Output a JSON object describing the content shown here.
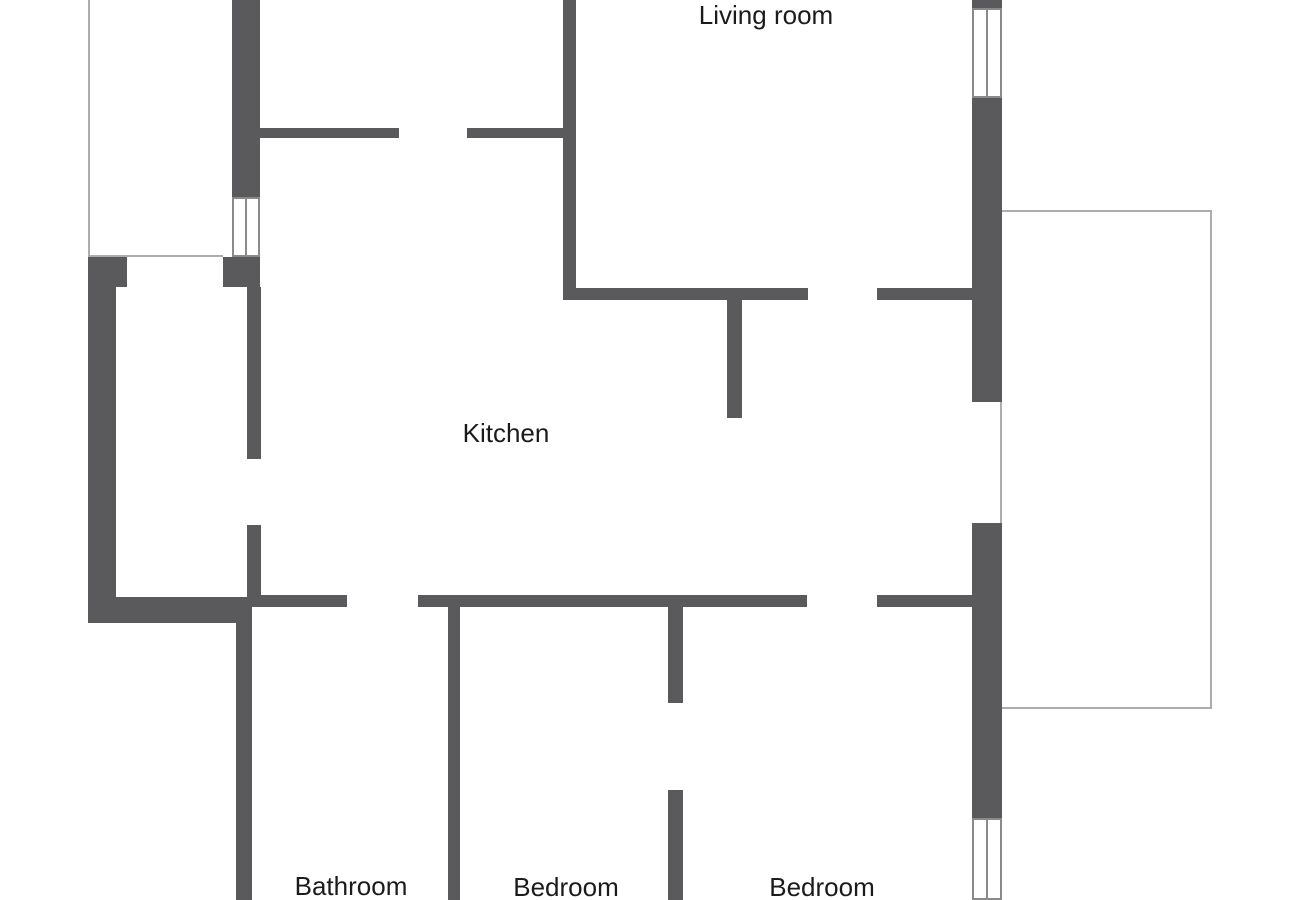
{
  "colors": {
    "background": "#ffffff",
    "wall": "#5a5a5c",
    "thin_line": "#adadad",
    "window_border": "#8a8a8a",
    "label_text": "#1b1b1b"
  },
  "rooms": [
    {
      "name": "room-label-living-room",
      "label": "Living room",
      "cx": 766,
      "cy": 15
    },
    {
      "name": "room-label-kitchen",
      "label": "Kitchen",
      "cx": 506,
      "cy": 433
    },
    {
      "name": "room-label-bathroom",
      "label": "Bathroom",
      "cx": 351,
      "cy": 886
    },
    {
      "name": "room-label-bedroom-1",
      "label": "Bedroom",
      "cx": 566,
      "cy": 887
    },
    {
      "name": "room-label-bedroom-2",
      "label": "Bedroom",
      "cx": 822,
      "cy": 887
    }
  ],
  "walls": [
    {
      "name": "wall-top-left-vertical",
      "x": 232,
      "y": 0,
      "w": 28,
      "h": 197
    },
    {
      "name": "wall-hall-top-a",
      "x": 255,
      "y": 128,
      "w": 144,
      "h": 10
    },
    {
      "name": "wall-hall-top-b",
      "x": 467,
      "y": 128,
      "w": 109,
      "h": 10
    },
    {
      "name": "wall-center-vertical",
      "x": 563,
      "y": 0,
      "w": 13,
      "h": 300
    },
    {
      "name": "wall-living-kitchen-a",
      "x": 563,
      "y": 288,
      "w": 245,
      "h": 12
    },
    {
      "name": "wall-living-kitchen-stub",
      "x": 727,
      "y": 300,
      "w": 15,
      "h": 118
    },
    {
      "name": "wall-living-kitchen-b",
      "x": 877,
      "y": 288,
      "w": 125,
      "h": 12
    },
    {
      "name": "wall-right-top-stub",
      "x": 972,
      "y": 0,
      "w": 30,
      "h": 8
    },
    {
      "name": "wall-right-upper",
      "x": 972,
      "y": 98,
      "w": 30,
      "h": 304
    },
    {
      "name": "wall-right-mid",
      "x": 972,
      "y": 523,
      "w": 30,
      "h": 295
    },
    {
      "name": "wall-left-corner-block",
      "x": 88,
      "y": 257,
      "w": 39,
      "h": 30
    },
    {
      "name": "wall-left-outer",
      "x": 88,
      "y": 287,
      "w": 28,
      "h": 336
    },
    {
      "name": "wall-entry-block",
      "x": 223,
      "y": 257,
      "w": 37,
      "h": 30
    },
    {
      "name": "wall-hall-vertical-upper",
      "x": 247,
      "y": 287,
      "w": 14,
      "h": 172
    },
    {
      "name": "wall-hall-vertical-lower",
      "x": 247,
      "y": 525,
      "w": 14,
      "h": 82
    },
    {
      "name": "wall-left-step",
      "x": 116,
      "y": 597,
      "w": 134,
      "h": 26
    },
    {
      "name": "wall-bathroom-left",
      "x": 236,
      "y": 597,
      "w": 16,
      "h": 303
    },
    {
      "name": "wall-hall-bottom",
      "x": 252,
      "y": 595,
      "w": 95,
      "h": 12
    },
    {
      "name": "wall-kitchen-bottom",
      "x": 418,
      "y": 595,
      "w": 389,
      "h": 12
    },
    {
      "name": "wall-bath-bedroom-divider",
      "x": 448,
      "y": 605,
      "w": 12,
      "h": 295
    },
    {
      "name": "wall-bedroom-divider-upper",
      "x": 668,
      "y": 605,
      "w": 15,
      "h": 98
    },
    {
      "name": "wall-bedroom-divider-lower",
      "x": 668,
      "y": 790,
      "w": 15,
      "h": 110
    },
    {
      "name": "wall-kitchen-bottom-b",
      "x": 877,
      "y": 595,
      "w": 125,
      "h": 12
    }
  ],
  "windows": [
    {
      "name": "window-top-left",
      "x": 232,
      "y": 197,
      "w": 28,
      "h": 60
    },
    {
      "name": "window-right-top",
      "x": 972,
      "y": 8,
      "w": 30,
      "h": 90
    },
    {
      "name": "window-right-bottom",
      "x": 972,
      "y": 818,
      "w": 30,
      "h": 82
    }
  ],
  "thin_lines": [
    {
      "name": "terrace-edge-left",
      "x": 88,
      "y": 0,
      "w": 2,
      "h": 257
    },
    {
      "name": "terrace-edge-bottom",
      "x": 88,
      "y": 255,
      "w": 135,
      "h": 2
    },
    {
      "name": "balcony-edge-top",
      "x": 1002,
      "y": 210,
      "w": 210,
      "h": 2
    },
    {
      "name": "balcony-edge-right",
      "x": 1210,
      "y": 210,
      "w": 2,
      "h": 499
    },
    {
      "name": "balcony-edge-bottom",
      "x": 1002,
      "y": 707,
      "w": 210,
      "h": 2
    },
    {
      "name": "balcony-door-opening-line",
      "x": 1000,
      "y": 402,
      "w": 2,
      "h": 121
    }
  ]
}
